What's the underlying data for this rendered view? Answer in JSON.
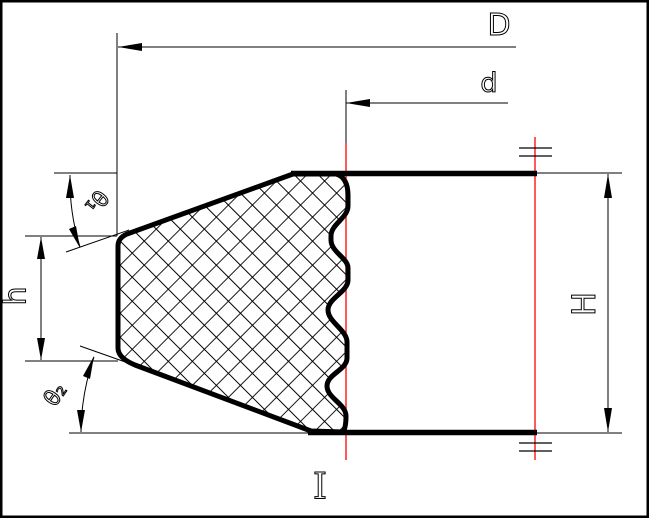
{
  "dimensions": {
    "outer_diameter": "D",
    "inner_diameter": "d",
    "total_height": "H",
    "step_height": "h",
    "angle_top": "θ₁",
    "angle_bottom": "θ₂"
  },
  "marks": {
    "section_label": "I"
  },
  "colors": {
    "line": "#000000",
    "centerline": "#ff0000",
    "background": "#ffffff"
  }
}
